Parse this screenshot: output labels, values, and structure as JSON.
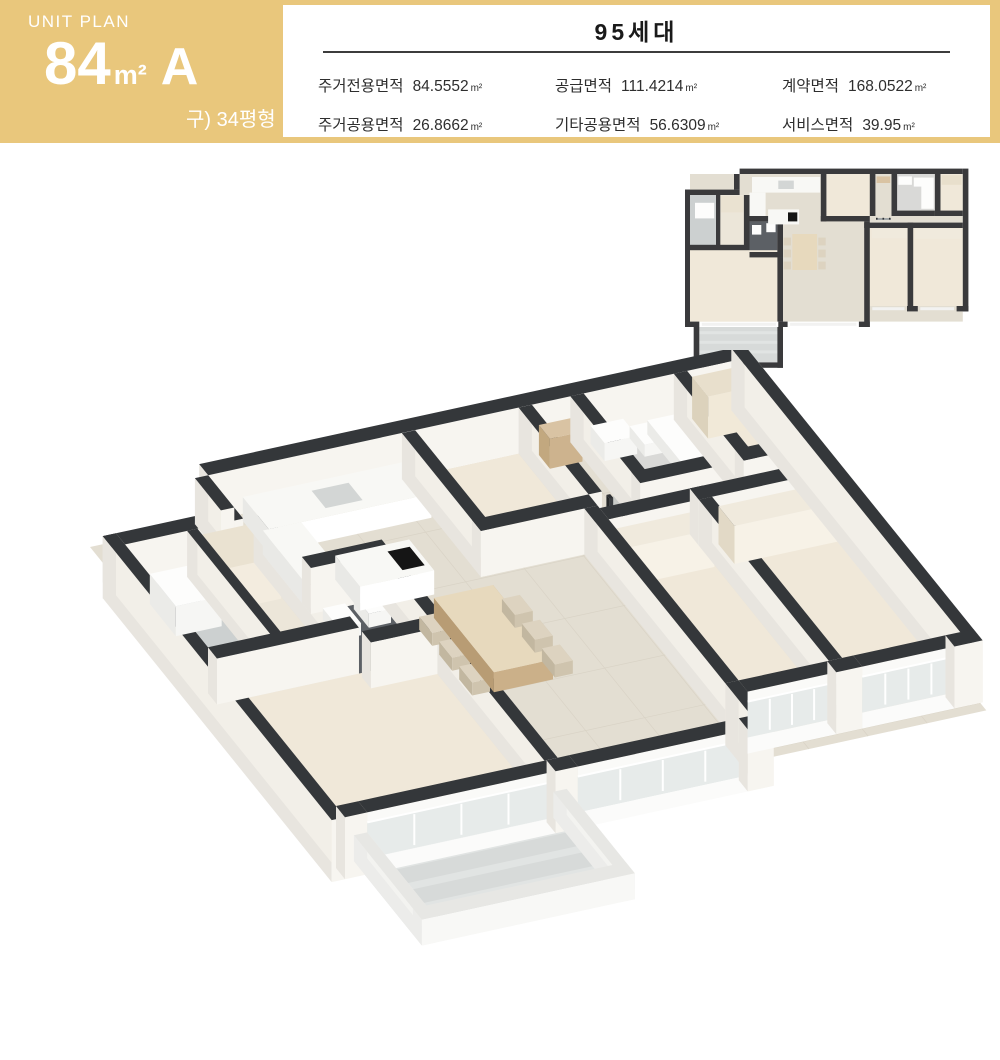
{
  "header": {
    "accent_color": "#e9c77c",
    "unit_plan_label": "UNIT PLAN",
    "area_number": "84",
    "area_unit": "m²",
    "type_letter": "A",
    "legacy_label": "구) 34평형"
  },
  "info_table": {
    "title": "95세대",
    "rows": [
      [
        {
          "label": "주거전용면적",
          "value": "84.5552",
          "unit": "m²"
        },
        {
          "label": "공급면적",
          "value": "111.4214",
          "unit": "m²"
        },
        {
          "label": "계약면적",
          "value": "168.0522",
          "unit": "m²"
        }
      ],
      [
        {
          "label": "주거공용면적",
          "value": "26.8662",
          "unit": "m²"
        },
        {
          "label": "기타공용면적",
          "value": "56.6309",
          "unit": "m²"
        },
        {
          "label": "서비스면적",
          "value": "39.95",
          "unit": "m²"
        }
      ]
    ]
  },
  "images": {
    "plan_2d_alt": "unit 2d floor plan",
    "plan_3d_alt": "unit 3d isometric floor plan"
  },
  "palette": {
    "wall_dark": "#34373a",
    "floor_tile": "#e3ded2",
    "floor_wood": "#f0e8d9",
    "bath_dark": "#5c6065",
    "balcony_gray": "#d7dad9"
  }
}
